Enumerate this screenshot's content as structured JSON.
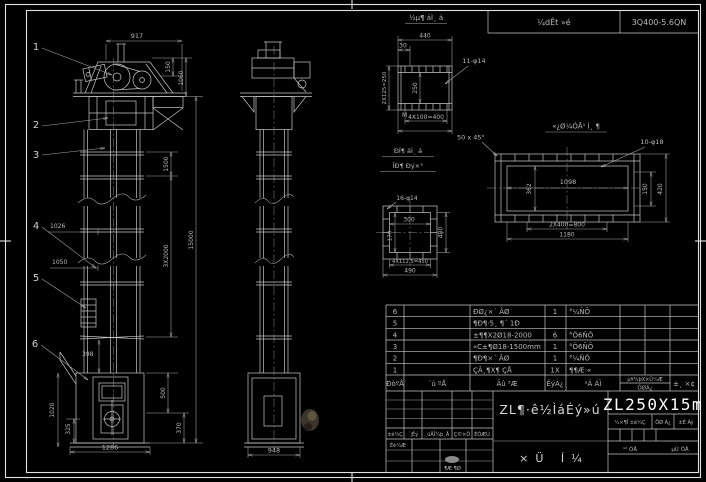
{
  "header_strip": {
    "cell1": "¼dÊt »é",
    "cell2": "3Q400-5.6QN"
  },
  "front_view": {
    "balloon1": "1",
    "balloon2": "2",
    "balloon3": "3",
    "balloon4": "4",
    "balloon5": "5",
    "balloon6": "6",
    "dim_top": "917",
    "dim_150": "150",
    "dim_1060": "1060",
    "dim_1500": "1500",
    "dim_15000": "15000",
    "dim_3x2000": "3X2000",
    "dim_1026": "1026",
    "dim_1050": "1050",
    "dim_398": "398",
    "dim_1020": "1020",
    "dim_325": "325",
    "dim_500": "500",
    "dim_370": "370",
    "dim_1286": "1286"
  },
  "side_view": {
    "dim_948": "948"
  },
  "detail_a": {
    "title": "½µ¶ áÌ¸ á",
    "dim_440": "440",
    "dim_30": "30",
    "holes": "11-φ14",
    "dim_left": "2X125=250",
    "dim_mid": "250",
    "label_m": "M",
    "dim_bottom": "4X100=400"
  },
  "detail_b": {
    "title": "«¿Ø¼ÓÅ¹ Ì¸ ¶",
    "chamfer": "50 x 45°",
    "holes": "10-φ18",
    "dim_w": "1098",
    "dim_h": "362",
    "dim_r1": "150",
    "dim_r2": "420",
    "dim_b1": "2X400=800",
    "dim_b2": "1180"
  },
  "detail_c": {
    "title1": "ÐÏ¶ áÌ¸ á",
    "title2": "ÎÐ¶ Ðý×°",
    "holes": "16-φ14",
    "dim_w": "300",
    "dim_l": "170",
    "dim_r": "400",
    "dim_b1": "4X112.5=450",
    "dim_b2": "490"
  },
  "bom": {
    "header": {
      "no": "ÐòºÅ",
      "code": "´ú ºÅ",
      "name": "Ãû ³Æ",
      "qty": "ÊýÁ¿",
      "material": "²Ä ÁÏ",
      "weight_top": "µ¥¼þX×Ü¼Æ",
      "weight_bottom": "ÖØÁ¿",
      "remark": "±¸ ×¢"
    },
    "rows": [
      {
        "no": "6",
        "code": "",
        "name": "ÐØ¿×´ ÂØ",
        "qty": "1",
        "material": "°¼ÑÕ"
      },
      {
        "no": "5",
        "code": "",
        "name": "¶Ð¶·5¸ ¶´ 1Ð",
        "qty": "",
        "material": ""
      },
      {
        "no": "4",
        "code": "",
        "name": "±¶¶X2Ø18-2000",
        "qty": "6",
        "material": "°Ö6ÑÕ"
      },
      {
        "no": "3",
        "code": "",
        "name": "«C±¶Ø18-1500mm",
        "qty": "1",
        "material": "°Ö6ÑÕ"
      },
      {
        "no": "2",
        "code": "",
        "name": "¶Ð¶×´ ÂØ",
        "qty": "1",
        "material": "°¼ÑÕ"
      },
      {
        "no": "1",
        "code": "",
        "name": "ÇÃ¸¶X¶ ÇÅ",
        "qty": "1X",
        "material": "¶¶Æ·«"
      }
    ]
  },
  "title_block": {
    "rev_label1": "±ê¼Ç",
    "rev_label2": "´¦Êý",
    "rev_label3": "¸üÄÎ¼þ¸Å",
    "rev_label4": "Ç©×Ö",
    "rev_label5": "ÈÕÆÚ",
    "design_label": "Éè¼Æ",
    "approve_label": "¶Æ ¶Ø",
    "drawing_title": "ZL¶·ê½ÌáÉý»ú",
    "sheet_label": "×Ü Í¼",
    "model": "ZL250X15m",
    "stage_label": "¼×¶Î ±ê¼Ç",
    "weight_label": "ÖØ Á¿",
    "scale_label": "±È Àý",
    "total_label": "¹² ÕÅ",
    "page_label": "µÚ ÕÅ"
  }
}
